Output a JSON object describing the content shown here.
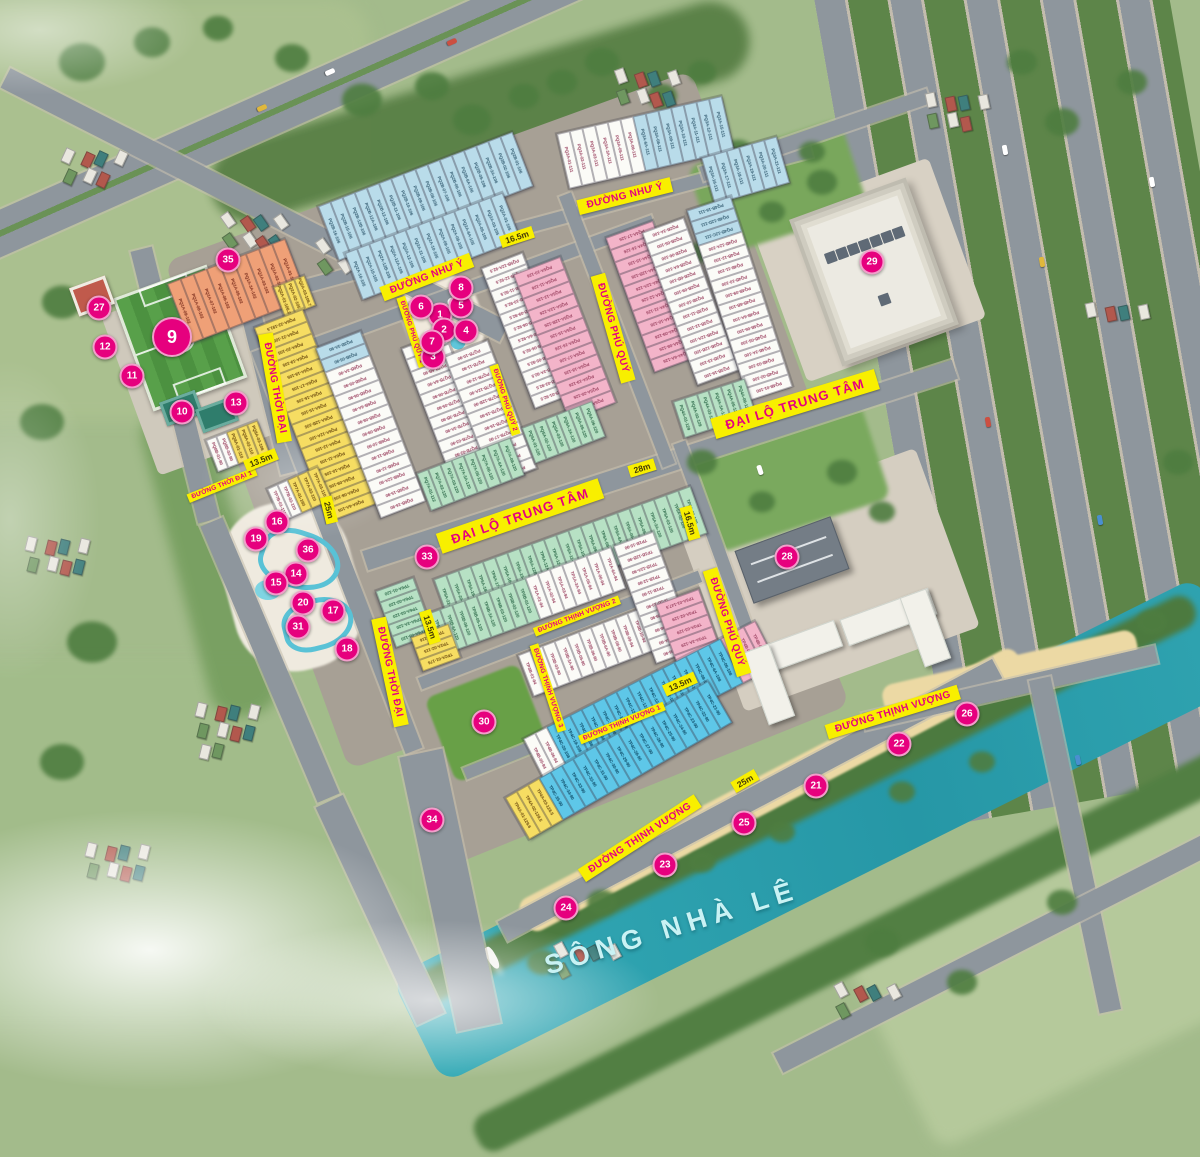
{
  "map": {
    "river_label": "SÔNG NHÀ LÊ",
    "colors": {
      "accent": "#e6007e",
      "banner_bg": "#f8ef00",
      "banner_text": "#e6007e",
      "river": "#2ba7b4",
      "lots": {
        "w": "#fbfbf7",
        "lb": "#b9dcea",
        "pk": "#f3b4c9",
        "mi": "#b7e1c4",
        "ye": "#f6dd62",
        "bl": "#5ec7e8",
        "or": "#efa077"
      }
    },
    "markers": [
      {
        "n": "1",
        "x": 440,
        "y": 315
      },
      {
        "n": "2",
        "x": 444,
        "y": 330
      },
      {
        "n": "3",
        "x": 433,
        "y": 357
      },
      {
        "n": "4",
        "x": 466,
        "y": 331
      },
      {
        "n": "5",
        "x": 461,
        "y": 306
      },
      {
        "n": "6",
        "x": 421,
        "y": 307
      },
      {
        "n": "7",
        "x": 432,
        "y": 342
      },
      {
        "n": "8",
        "x": 461,
        "y": 288
      },
      {
        "n": "9",
        "x": 172,
        "y": 337,
        "b": 1
      },
      {
        "n": "10",
        "x": 182,
        "y": 412
      },
      {
        "n": "11",
        "x": 132,
        "y": 376
      },
      {
        "n": "12",
        "x": 105,
        "y": 347
      },
      {
        "n": "13",
        "x": 236,
        "y": 403
      },
      {
        "n": "14",
        "x": 296,
        "y": 574
      },
      {
        "n": "15",
        "x": 276,
        "y": 583
      },
      {
        "n": "16",
        "x": 277,
        "y": 522
      },
      {
        "n": "17",
        "x": 333,
        "y": 611
      },
      {
        "n": "18",
        "x": 347,
        "y": 649
      },
      {
        "n": "19",
        "x": 256,
        "y": 539
      },
      {
        "n": "20",
        "x": 303,
        "y": 603
      },
      {
        "n": "21",
        "x": 816,
        "y": 786
      },
      {
        "n": "22",
        "x": 899,
        "y": 744
      },
      {
        "n": "23",
        "x": 665,
        "y": 865
      },
      {
        "n": "24",
        "x": 566,
        "y": 908
      },
      {
        "n": "25",
        "x": 744,
        "y": 823
      },
      {
        "n": "26",
        "x": 967,
        "y": 714
      },
      {
        "n": "27",
        "x": 99,
        "y": 308
      },
      {
        "n": "28",
        "x": 787,
        "y": 557
      },
      {
        "n": "29",
        "x": 872,
        "y": 262
      },
      {
        "n": "30",
        "x": 484,
        "y": 722
      },
      {
        "n": "31",
        "x": 298,
        "y": 627
      },
      {
        "n": "33",
        "x": 427,
        "y": 557
      },
      {
        "n": "34",
        "x": 432,
        "y": 820
      },
      {
        "n": "35",
        "x": 228,
        "y": 260
      },
      {
        "n": "36",
        "x": 308,
        "y": 550
      }
    ],
    "road_labels": [
      {
        "t": "ĐƯỜNG NHƯ Ý",
        "x": 625,
        "y": 196,
        "r": -14,
        "s": "md"
      },
      {
        "t": "ĐƯỜNG NHƯ Ý",
        "x": 427,
        "y": 277,
        "r": -21,
        "s": "md"
      },
      {
        "t": "ĐẠI LỘ TRUNG TÂM",
        "x": 520,
        "y": 516,
        "r": -19,
        "s": "big"
      },
      {
        "t": "ĐẠI LỘ TRUNG TÂM",
        "x": 795,
        "y": 404,
        "r": -17,
        "s": "big"
      },
      {
        "t": "ĐƯỜNG PHÚ QUÝ",
        "x": 613,
        "y": 328,
        "r": 74,
        "s": "md"
      },
      {
        "t": "ĐƯỜNG PHÚ QUÝ",
        "x": 727,
        "y": 622,
        "r": 72,
        "s": "md"
      },
      {
        "t": "ĐƯỜNG THỜI ĐẠI",
        "x": 275,
        "y": 388,
        "r": 80,
        "s": "md"
      },
      {
        "t": "ĐƯỜNG THỜI ĐẠI",
        "x": 390,
        "y": 672,
        "r": 78,
        "s": "md"
      },
      {
        "t": "ĐƯỜNG THỜI ĐẠI 1",
        "x": 222,
        "y": 485,
        "r": -22,
        "s": "sm"
      },
      {
        "t": "ĐƯỜNG PHÚ QUÝ 1",
        "x": 412,
        "y": 332,
        "r": 72,
        "s": "sm"
      },
      {
        "t": "ĐƯỜNG PHÚ QUÝ 2",
        "x": 505,
        "y": 400,
        "r": 72,
        "s": "sm"
      },
      {
        "t": "ĐƯỜNG THỊNH VƯỢNG 2",
        "x": 577,
        "y": 616,
        "r": -21,
        "s": "sm"
      },
      {
        "t": "ĐƯỜNG THỊNH VƯỢNG 1",
        "x": 622,
        "y": 723,
        "r": -22,
        "s": "sm"
      },
      {
        "t": "ĐƯỜNG THỊNH VƯỢNG 3",
        "x": 548,
        "y": 688,
        "r": 72,
        "s": "sm"
      },
      {
        "t": "ĐƯỜNG THỊNH VƯỢNG",
        "x": 640,
        "y": 838,
        "r": -33,
        "s": "md"
      },
      {
        "t": "ĐƯỜNG THỊNH VƯỢNG",
        "x": 893,
        "y": 712,
        "r": -17,
        "s": "md"
      }
    ],
    "dimension_labels": [
      {
        "t": "16.5m",
        "x": 517,
        "y": 237,
        "r": -18
      },
      {
        "t": "16.5m",
        "x": 690,
        "y": 523,
        "r": 74
      },
      {
        "t": "28m",
        "x": 642,
        "y": 468,
        "r": -17
      },
      {
        "t": "25m",
        "x": 329,
        "y": 510,
        "r": 76
      },
      {
        "t": "25m",
        "x": 745,
        "y": 781,
        "r": -30
      },
      {
        "t": "13.5m",
        "x": 261,
        "y": 460,
        "r": -22
      },
      {
        "t": "13.5m",
        "x": 680,
        "y": 684,
        "r": -24
      },
      {
        "t": "13.5m",
        "x": 430,
        "y": 627,
        "r": 72
      }
    ],
    "blocks": [
      {
        "n": "nhuy-a",
        "x": 425,
        "y": 196,
        "r": -21,
        "sw": 13,
        "sh": 58,
        "lots": [
          "lb|PQ2B-16-106",
          "lb|PQ2B-15-106",
          "lb|PQ2B-12B-106",
          "lb|PQ2B-12A-106",
          "lb|PQ2B-12-106",
          "lb|PQ2B-11-106",
          "lb|PQ2B-10-106",
          "lb|PQ2B-09-106",
          "lb|PQ2B-08-106",
          "lb|PQ2B-07-106",
          "lb|PQ2B-06-106",
          "lb|PQ2B-6A-106",
          "lb|PQ2B-05-106",
          "lb|PQ2B-3A-106",
          "lb|PQ2B-02-106",
          "lb|PQ2B-01-106"
        ]
      },
      {
        "n": "nhuy-b",
        "x": 432,
        "y": 246,
        "r": -21,
        "sw": 13,
        "sh": 50,
        "lots": [
          "lb|PQ2A-16-105",
          "lb|PQ2A-15-105",
          "lb|PQ2A-12B-105",
          "lb|PQ2A-12A-105",
          "lb|PQ2A-12-105",
          "lb|PQ2A-11-105",
          "lb|PQ2A-10-105",
          "lb|PQ2A-09-105",
          "lb|PQ2A-08-105",
          "lb|PQ2A-6A-105",
          "lb|PQ2A-05-105",
          "lb|PQ2A-03-105",
          "lb|PQ2A-01-105"
        ]
      },
      {
        "n": "nhuy-c",
        "x": 645,
        "y": 142,
        "r": -13,
        "sw": 13,
        "sh": 56,
        "lots": [
          "w|PQ3A-01-111",
          "w|PQ3A-02-111",
          "w|PQ3A-03-111",
          "w|PQ3A-3A-111",
          "w|PQ3A-05-111",
          "w|PQ3A-06-111",
          "lb|PQ3A-6A-111",
          "lb|PQ3A-08-111",
          "lb|PQ3A-09-111",
          "lb|PQ3A-10-111",
          "lb|PQ3A-11-111",
          "lb|PQ3A-12-111",
          "lb|PQ3A-15-111"
        ]
      },
      {
        "n": "nhuy-d",
        "x": 745,
        "y": 170,
        "r": -16,
        "sw": 13,
        "sh": 48,
        "lots": [
          "lb|PQ3A-16-111",
          "lb|PQ3A-17-111",
          "lb|PQ3A-18-111",
          "lb|PQ3A-19-111",
          "lb|PQ3A-20-111",
          "lb|PQ3A-21-111"
        ]
      },
      {
        "n": "pq1a",
        "x": 237,
        "y": 291,
        "r": -21,
        "sw": 14,
        "sh": 64,
        "lots": [
          "or|PQ1A-09-102",
          "or|PQ1A-08-102",
          "or|PQ1A-07-102",
          "or|PQ1A-06-102",
          "or|PQ1A-05-102",
          "or|PQ1A-3A-102",
          "or|PQ1A-03-102",
          "or|PQ1A-02-102",
          "or|PQ1A-01-102"
        ]
      },
      {
        "n": "pq2a-y",
        "x": 294,
        "y": 296,
        "r": -21,
        "sw": 11,
        "sh": 32,
        "lots": [
          "ye|PQ2A-01-106.2",
          "ye|PQ2A-02-105",
          "ye|PQ2A-03-106.7"
        ]
      },
      {
        "n": "pq6a",
        "x": 316,
        "y": 415,
        "r": 69,
        "sw": 13,
        "sh": 52,
        "lots": [
          "ye|PQ6A-22-191.5",
          "ye|PQ6A-21-105",
          "ye|PQ6A-20-105",
          "ye|PQ6A-19-105",
          "ye|PQ6A-18-105",
          "ye|PQ6A-17-105",
          "ye|PQ6A-16-105",
          "ye|PQ6A-15-105",
          "ye|PQ6A-12B-105",
          "ye|PQ6A-12A-105",
          "ye|PQ6A-12-105",
          "ye|PQ6A-11-105",
          "ye|PQ6A-10-105",
          "ye|PQ6A-09-105",
          "ye|PQ6A-08-105",
          "ye|PQ6A-6A-105"
        ]
      },
      {
        "n": "pq6b",
        "x": 371,
        "y": 424,
        "r": 69,
        "sw": 13,
        "sh": 48,
        "lots": [
          "lb|PQ3B-3A-90",
          "lb|PQ3B-05-90",
          "w|PQ6B-3A-90",
          "w|PQ6B-05-90",
          "w|PQ6B-06-90",
          "w|PQ6B-6A-90",
          "w|PQ6B-08-90",
          "w|PQ6B-09-90",
          "w|PQ6B-10-90",
          "w|PQ6B-11-90",
          "w|PQ6B-12-90",
          "w|PQ6B-12A-90",
          "w|PQ6B-15-90",
          "w|PQ6B-16-90"
        ]
      },
      {
        "n": "pq7b-a",
        "x": 448,
        "y": 404,
        "r": 69,
        "sw": 12.5,
        "sh": 46,
        "lots": [
          "w|PQ7B-09-90",
          "w|PQ7B-08-90",
          "w|PQ7B-6B-90",
          "w|PQ7B-6A-90",
          "w|PQ7B-06-90",
          "w|PQ7B-05-90",
          "w|PQ7B-3B-90",
          "w|PQ7B-3A-90",
          "w|PQ7B-03-90",
          "w|PQ7B-02-90",
          "w|PQ7B-01-90"
        ]
      },
      {
        "n": "pq7b-b",
        "x": 491,
        "y": 412,
        "r": 69,
        "sw": 12.5,
        "sh": 46,
        "lots": [
          "w|PQ7B-10-90",
          "w|PQ7B-11-90",
          "w|PQ7B-12-90",
          "w|PQ7B-12A-90",
          "w|PQ7B-12B-90",
          "w|PQ7B-15-90",
          "w|PQ7B-16-90",
          "w|PQ7B-17-90",
          "w|PQ7B-18-90",
          "w|PQ7B-19-90",
          "w|PQ7B-20-90"
        ]
      },
      {
        "n": "pq7a",
        "x": 470,
        "y": 474,
        "r": -21,
        "sw": 12.5,
        "sh": 40,
        "lots": [
          "mi|PQ7A-01-112",
          "mi|PQ7A-02-120",
          "mi|PQ7A-03-120",
          "mi|PQ7A-3A-120",
          "mi|PQ7A-05-120",
          "mi|PQ7A-06-120",
          "mi|PQ7A-6A-120",
          "mi|PQ7A-08-120"
        ]
      },
      {
        "n": "pq5b",
        "x": 529,
        "y": 330,
        "r": 69,
        "sw": 12.5,
        "sh": 44,
        "lots": [
          "w|PQ5B-12A-92.5",
          "w|PQ5B-12-92.5",
          "w|PQ5B-11-92.5",
          "w|PQ5B-10-92.5",
          "w|PQ5B-09-92.5",
          "w|PQ5B-08-92.5",
          "w|PQ5B-6A-92.5",
          "w|PQ5B-06-92.5",
          "w|PQ5B-05-92.5",
          "w|PQ5B-3A-92.5",
          "w|PQ5B-02-92.5",
          "w|PQ5B-01-92.5"
        ]
      },
      {
        "n": "pq5a",
        "x": 565,
        "y": 338,
        "r": 69,
        "sw": 13,
        "sh": 50,
        "lots": [
          "pk|PQ5A-10-126",
          "pk|PQ5A-11-126",
          "pk|PQ5A-12-126",
          "pk|PQ5A-12A-126",
          "pk|PQ5A-12B-126",
          "pk|PQ5A-15-126",
          "pk|PQ5A-16-126",
          "pk|PQ5A-17-126",
          "pk|PQ5A-18-126",
          "pk|PQ5A-19-126",
          "pk|PQ5A-20-126",
          "pk|PQ5A-6A-126"
        ]
      },
      {
        "n": "pq5-cap",
        "x": 563,
        "y": 432,
        "r": -21,
        "sw": 12.5,
        "sh": 38,
        "lots": [
          "mi|PQ5A-01-120",
          "mi|PQ5A-02-120",
          "mi|PQ5A-03-120",
          "mi|PQ5A-3A-120",
          "mi|PQ5A-05-120",
          "mi|PQ5A-06-120"
        ]
      },
      {
        "n": "pq4a",
        "x": 654,
        "y": 296,
        "r": 70,
        "sw": 13,
        "sh": 50,
        "lots": [
          "pk|PQ4A-17-126",
          "pk|PQ4A-16-126",
          "pk|PQ4A-15-126",
          "pk|PQ4A-12B-126",
          "pk|PQ4A-12A-126",
          "pk|PQ4A-12-126",
          "pk|PQ4A-11-126",
          "pk|PQ4A-10-126",
          "pk|PQ4A-09-126",
          "pk|PQ4A-08-126",
          "pk|PQ4A-6A-126"
        ]
      },
      {
        "n": "pq23b",
        "x": 691,
        "y": 301,
        "r": 70,
        "sw": 12.5,
        "sh": 44,
        "lots": [
          "w|PQ2B-3A-100",
          "w|PQ2B-05-100",
          "w|PQ2B-06-100",
          "w|PQ2B-6A-100",
          "w|PQ2B-6B-100",
          "w|PQ2B-09-100",
          "w|PQ3B-10-100",
          "w|PQ3B-11-100",
          "w|PQ3B-12-100",
          "w|PQ3B-12A-100",
          "w|PQ3B-12B-100",
          "w|PQ3B-15-100",
          "w|PQ3B-16-100"
        ]
      },
      {
        "n": "pq4b",
        "x": 740,
        "y": 298,
        "r": 72,
        "sw": 12.5,
        "sh": 46,
        "lots": [
          "lb|PQ4B-16-111",
          "lb|PQ4B-12D-111",
          "lb|PQ4B-12C-111",
          "w|PQ4B-12A-100",
          "w|PQ4B-12-100",
          "w|PQ4B-11-100",
          "w|PQ4B-10-100",
          "w|PQ4B-09-100",
          "w|PQ4B-6B-100",
          "w|PQ4B-6A-100",
          "w|PQ4B-06-100",
          "w|PQ4B-05-100",
          "w|PQ4B-3A-100",
          "w|PQ4B-03-100",
          "w|PQ4B-02-100",
          "w|PQ4B-01-100"
        ]
      },
      {
        "n": "pq4a-cap",
        "x": 714,
        "y": 408,
        "r": -18,
        "sw": 12.5,
        "sh": 38,
        "lots": [
          "mi|PQ4A-01-129",
          "mi|PQ4A-02-129",
          "mi|PQ4A-03-129",
          "mi|PQ4A-3A-129",
          "mi|PQ4A-05-129",
          "mi|PQ4A-06-129"
        ]
      },
      {
        "n": "tp5a",
        "x": 570,
        "y": 556,
        "r": -20,
        "sw": 13,
        "sh": 50,
        "lots": [
          "mi|TP5A-21-120",
          "mi|TP5A-20-120",
          "mi|TP5A-19-120",
          "mi|TP5A-18-120",
          "mi|TP5A-17-120",
          "mi|TP5A-16-120",
          "mi|TP5A-15-120",
          "mi|TP5A-12B-120",
          "mi|TP5A-12A-120",
          "mi|TP5A-12-120",
          "mi|TP5A-11-120",
          "mi|TP5A-10-120",
          "mi|TP5A-09-120",
          "mi|TP5A-08-120",
          "mi|TP5A-6A-120",
          "mi|TP5A-06-120",
          "mi|TP5A-05-120",
          "mi|TP5A-3A-120",
          "mi|TP5A-03-120",
          "mi|TP5A-02-120",
          "mi|TP5A-01-120"
        ]
      },
      {
        "n": "tp5b",
        "x": 520,
        "y": 603,
        "r": -20,
        "sw": 13,
        "sh": 44,
        "lots": [
          "mi|TP5B-09-120",
          "mi|TP5B-08-120",
          "mi|TP5B-6A-120",
          "mi|TP5B-06-120",
          "mi|TP5B-05-120",
          "mi|TP5B-3A-120",
          "mi|TP5B-03-120",
          "mi|TP5B-02-120",
          "mi|TP5B-01-120",
          "w|TP1A-01-94",
          "w|TP1A-02-94",
          "w|TP1A-03-94",
          "w|TP1A-3A-94",
          "w|TP1A-05-94",
          "w|TP1A-06-94",
          "w|TP1A-6A-94"
        ]
      },
      {
        "n": "tp6a",
        "x": 405,
        "y": 612,
        "r": 70,
        "sw": 12,
        "sh": 40,
        "lots": [
          "mi|TP6A-01-120",
          "mi|TP6A-02-120",
          "mi|TP6A-03-120",
          "mi|TP6A-3A-120",
          "mi|TP6A-05-120"
        ]
      },
      {
        "n": "tp2a",
        "x": 436,
        "y": 647,
        "r": 70,
        "sw": 12,
        "sh": 40,
        "lots": [
          "ye|TP2A-03-116",
          "ye|TP2A-02-115",
          "ye|TP2A-01-176"
        ]
      },
      {
        "n": "tp3b",
        "x": 592,
        "y": 650,
        "r": -21,
        "sw": 13,
        "sh": 44,
        "lots": [
          "w|TP3B-01-94",
          "w|TP3B-02-90",
          "w|TP3B-03-90",
          "w|TP3B-3A-90",
          "w|TP3B-05-90",
          "w|TP3B-06-90",
          "w|TP3B-6A-90",
          "w|TP3B-08-90",
          "w|TP3B-09-94",
          "w|TP3B-10-94",
          "w|TP3B-11-94"
        ]
      },
      {
        "n": "tp1b",
        "x": 655,
        "y": 597,
        "r": 70,
        "sw": 12.5,
        "sh": 42,
        "lots": [
          "w|TP1B-15-90",
          "w|TP1B-12B-90",
          "w|TP1B-12A-90",
          "w|TP1B-12-90",
          "w|TP1B-11-90",
          "w|TP1B-10-90",
          "w|TP1B-09-90",
          "w|TP1B-08-90",
          "w|TP1B-6A-90",
          "w|TP1B-06-90"
        ]
      },
      {
        "n": "tp3a",
        "x": 689,
        "y": 628,
        "r": 70,
        "sw": 13.5,
        "sh": 46,
        "lots": [
          "pk|TP3A-01-147.5",
          "pk|TP3A-02-129",
          "pk|TP3A-03-129",
          "pk|TP3A-3A-129",
          "pk|TP3A-05-135.2"
        ]
      },
      {
        "n": "tp4c-a",
        "x": 650,
        "y": 702,
        "r": -27,
        "sw": 13,
        "sh": 50,
        "lots": [
          "w|TP4B-05-94",
          "w|TP4B-06-94",
          "bl|TP4C-20-108",
          "bl|TP4C-19-108",
          "bl|TP4C-18-108",
          "bl|TP4C-17-108",
          "bl|TP4C-16-108",
          "bl|TP4C-15-108",
          "bl|TP4C-12B-108",
          "bl|TP4C-12A-108",
          "bl|TP4C-12-108",
          "bl|TP4C-11-108",
          "bl|TP4C-10-108",
          "bl|TP4C-09-108",
          "bl|TP4C-08-108",
          "bl|TP4C-6A-108",
          "bl|TP4C-06-108",
          "pk|TP4B-01-139.2",
          "pk|TP4B-02-144.9",
          "pk|TP4B-03-141"
        ]
      },
      {
        "n": "tp4c-b",
        "x": 618,
        "y": 760,
        "r": -30,
        "sw": 13,
        "sh": 48,
        "lots": [
          "ye|TP4A-01-129.6",
          "ye|TP4A-02-139.5",
          "ye|TP4A-03-128.5",
          "bl|TP4C-35-90",
          "bl|TP4C-34-90",
          "bl|TP4C-33-90",
          "bl|TP4C-32-90",
          "bl|TP4C-31-90",
          "bl|TP4C-30-90",
          "bl|TP4C-29-90",
          "bl|TP4C-28-90",
          "bl|TP4C-27-90",
          "bl|TP4C-26-90",
          "bl|TP4C-25-90",
          "bl|TP4C-24-90",
          "bl|TP4C-23-90",
          "bl|TP4C-22-90",
          "bl|TP4C-21-90"
        ]
      },
      {
        "n": "tp7a",
        "x": 299,
        "y": 494,
        "r": -24,
        "sw": 11,
        "sh": 36,
        "lots": [
          "w|TP7B-01-110",
          "w|TP7B-02-110",
          "ye|TP7A-01-160",
          "ye|TP7A-02-110",
          "ye|TP7A-03-110"
        ]
      },
      {
        "n": "pq8",
        "x": 237,
        "y": 446,
        "r": -21,
        "sw": 11,
        "sh": 34,
        "lots": [
          "w|PQ8B-01-90",
          "w|PQ8B-02-90",
          "ye|PQ8A-01-110",
          "ye|PQ8A-02-110",
          "ye|PQ8A-03-106"
        ]
      }
    ]
  }
}
